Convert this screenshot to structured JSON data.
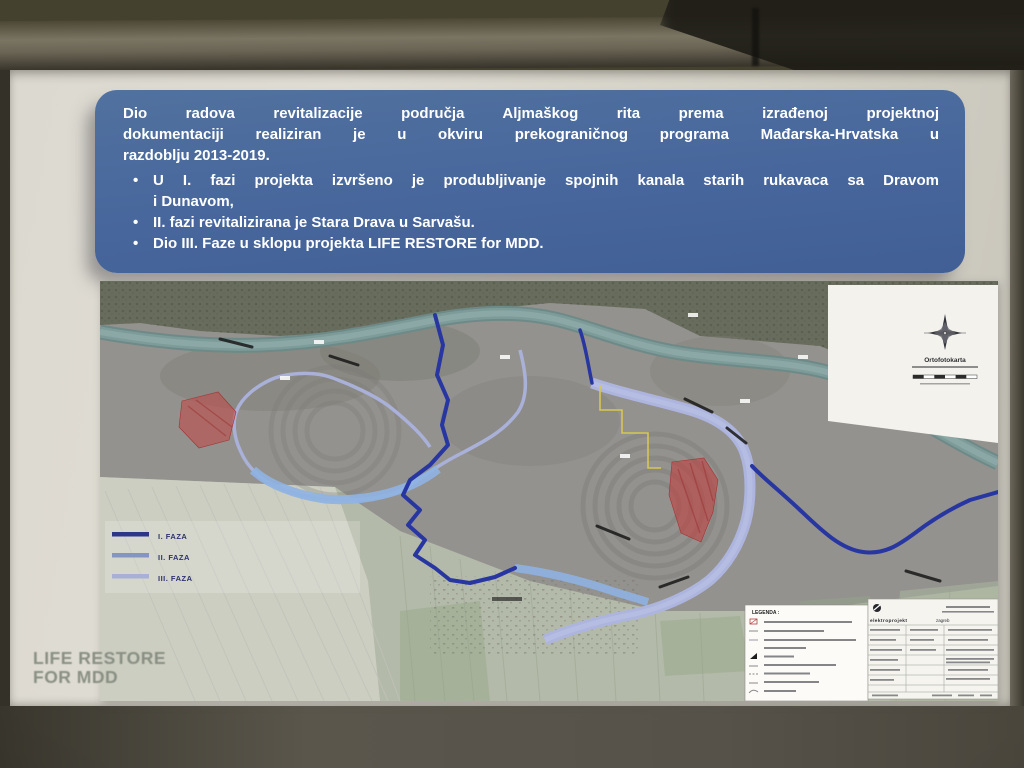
{
  "slide": {
    "header_box": {
      "bg_color": "#47669c",
      "text_color": "#ffffff",
      "paragraph_lines": [
        "Dio radova revitalizacije područja Aljmaškog rita prema izrađenoj projektnoj",
        "dokumentaciji realiziran je u okviru prekograničnog programa Mađarska-Hrvatska u",
        "razdoblju 2013-2019."
      ],
      "bullet_marker": "•",
      "bullets": [
        {
          "lines": [
            "U I. fazi projekta izvršeno je produbljivanje spojnih kanala starih rukavaca sa Dravom",
            "i Dunavom,"
          ]
        },
        {
          "lines": [
            "II. fazi revitalizirana je Stara Drava u Sarvašu."
          ]
        },
        {
          "lines": [
            "Dio III. Faze u sklopu projekta LIFE RESTORE for MDD."
          ]
        }
      ]
    },
    "footer_logo": {
      "line1": "LIFE RESTORE",
      "line2": "FOR MDD",
      "color": "#858c80"
    },
    "map": {
      "phase_legend": [
        {
          "label": "I. FAZA",
          "color": "#2c3587"
        },
        {
          "label": "II. FAZA",
          "color": "#8495c4"
        },
        {
          "label": "III. FAZA",
          "color": "#a9b0d6"
        }
      ],
      "inset": {
        "title": "Ortofotokarta"
      },
      "legend_box": {
        "title": "LEGENDA :"
      },
      "title_block": {
        "company": "elektroprojekt",
        "city": "zagreb"
      },
      "line_colors": {
        "phase1": "#2836a2",
        "phase2": "#8fb3e2",
        "phase3": "#adb5de",
        "river": "#7d9b99",
        "cadastral": "#d8c751",
        "intervention_area": "#c24444"
      }
    }
  }
}
